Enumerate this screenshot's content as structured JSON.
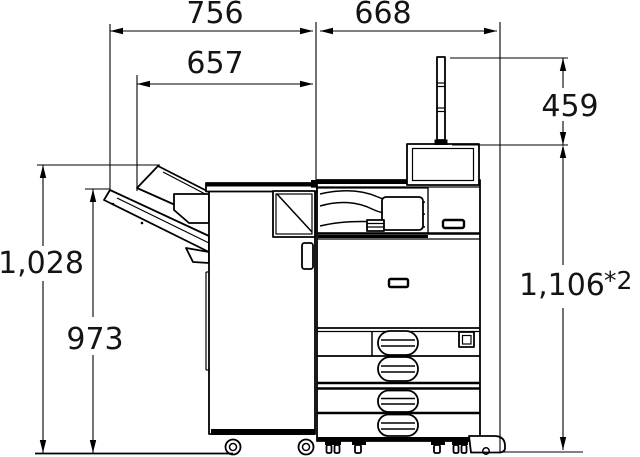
{
  "figure": {
    "type": "technical-dimension-diagram",
    "subject": "printer-with-finisher-side-view",
    "line_color": "#000000",
    "text_color": "#141414",
    "background": "#ffffff"
  },
  "dimensions": {
    "finisher_width_top": "756",
    "printer_width_top": "668",
    "tray_width_inner": "657",
    "panel_pole_height": "459",
    "upper_tray_height": "1,028",
    "lower_tray_height": "973",
    "overall_height": "1,106",
    "overall_height_note": "*2"
  }
}
